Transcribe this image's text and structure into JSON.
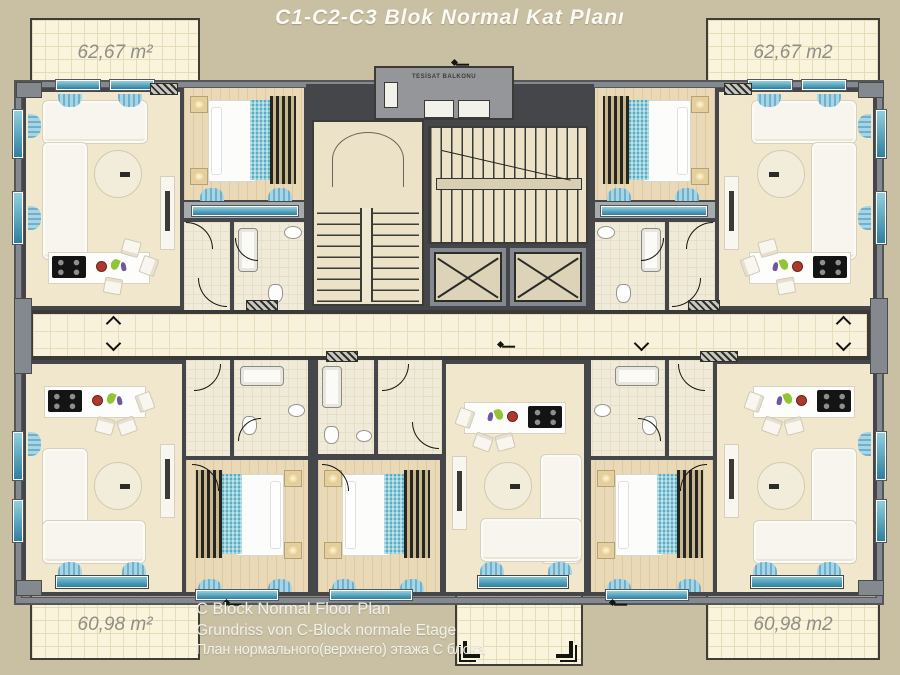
{
  "title": "C1-C2-C3 Blok Normal Kat Planı",
  "balconies": {
    "top_left": {
      "area": "62,67 m²"
    },
    "top_right": {
      "area": "62,67 m2"
    },
    "bottom_left": {
      "area": "60,98 m²"
    },
    "bottom_right": {
      "area": "60,98 m2"
    }
  },
  "core": {
    "utility_balcony_label": "TESİSAT BALKONU"
  },
  "caption": {
    "line1": "C Block Normal Floor Plan",
    "line2": "Grundriss von C-Block normale Etage",
    "line3": "План нормального(верхнего) этажа С блока"
  },
  "colors": {
    "bg": "#c9c0a4",
    "title_white": "#fbfaf4",
    "label_gray": "#8f8e86",
    "pad_bg": "#faf4dd",
    "pad_grid": "#e5dcba",
    "pad_border": "#3e3d36",
    "wall_dark": "#45464a",
    "wall_gray": "#84898f",
    "floor_living": "#f0e7cc",
    "floor_wood": "#e9d9b6",
    "floor_tile": "#f0ead8",
    "corridor_tile": "#f8f2dc",
    "corridor_grid": "#e7ddbb",
    "core_floor": "#ebe2c7",
    "glass_teal": "#2e7f9f",
    "curtain": "#a8d5e5",
    "curtain_dark": "#6fb0ca",
    "sofa": "#f7f5ed",
    "sofa_border": "#d6d0be",
    "runner": "#55aec2",
    "stripe_dark": "#26251f",
    "stripe_warm": "#c8b68c",
    "cooktop": "#141414",
    "burner": "#8e8e8e",
    "red": "#ac3a2c",
    "green": "#93c435",
    "purple": "#6f56a0",
    "lift_inner": "#dcd3b8",
    "gray_balcony": "#95969a"
  }
}
